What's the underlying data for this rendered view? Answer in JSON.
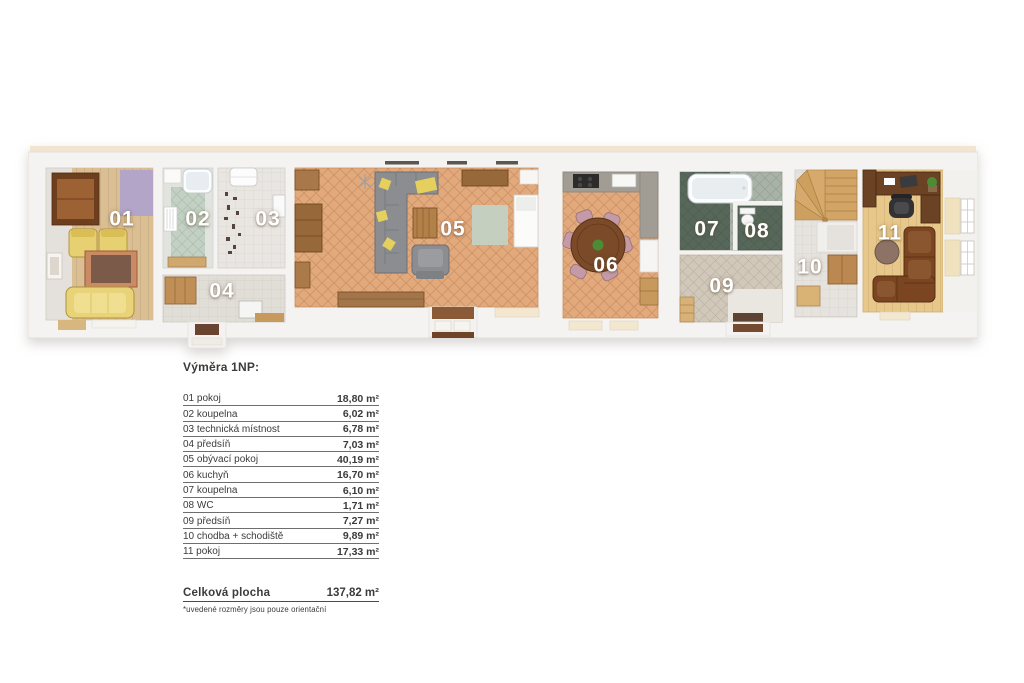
{
  "plan": {
    "room_numbers": [
      "01",
      "02",
      "03",
      "04",
      "05",
      "06",
      "07",
      "08",
      "09",
      "10",
      "11"
    ]
  },
  "legend": {
    "title": "Výměra 1NP:",
    "rows": [
      {
        "label": "01 pokoj",
        "area": "18,80 m²"
      },
      {
        "label": "02 koupelna",
        "area": "6,02 m²"
      },
      {
        "label": "03 technická místnost",
        "area": "6,78 m²"
      },
      {
        "label": "04 předsíň",
        "area": "7,03 m²"
      },
      {
        "label": "05 obývací pokoj",
        "area": "40,19 m²"
      },
      {
        "label": "06 kuchyň",
        "area": "16,70 m²"
      },
      {
        "label": "07 koupelna",
        "area": "6,10 m²"
      },
      {
        "label": "08 WC",
        "area": "1,71 m²"
      },
      {
        "label": "09 předsíň",
        "area": "7,27 m²"
      },
      {
        "label": "10 chodba + schodiště",
        "area": "9,89 m²"
      },
      {
        "label": "11 pokoj",
        "area": "17,33 m²"
      }
    ],
    "total": {
      "label": "Celková plocha",
      "area": "137,82 m²"
    },
    "footnote": "*uvedené rozměry jsou pouze orientační"
  },
  "colors": {
    "wall": "#f5f3f1",
    "floor_terracotta": "#e2a97c",
    "floor_wood_light": "#dbbf93",
    "floor_oak": "#e8c88a",
    "tile_green_pale": "#c2d1c3",
    "tile_green_dark": "#57685a",
    "tile_beige": "#d1c8ba",
    "rug_lavender": "#b2a5c8",
    "rug_sage": "#c4cfc0",
    "sofa_yellow": "#e9d378",
    "sofa_gray": "#8b8d90",
    "sofa_brown": "#7b4522",
    "wood_dark": "#6b4223",
    "stair_wood": "#d2a566",
    "text": "#3b3b3b"
  }
}
